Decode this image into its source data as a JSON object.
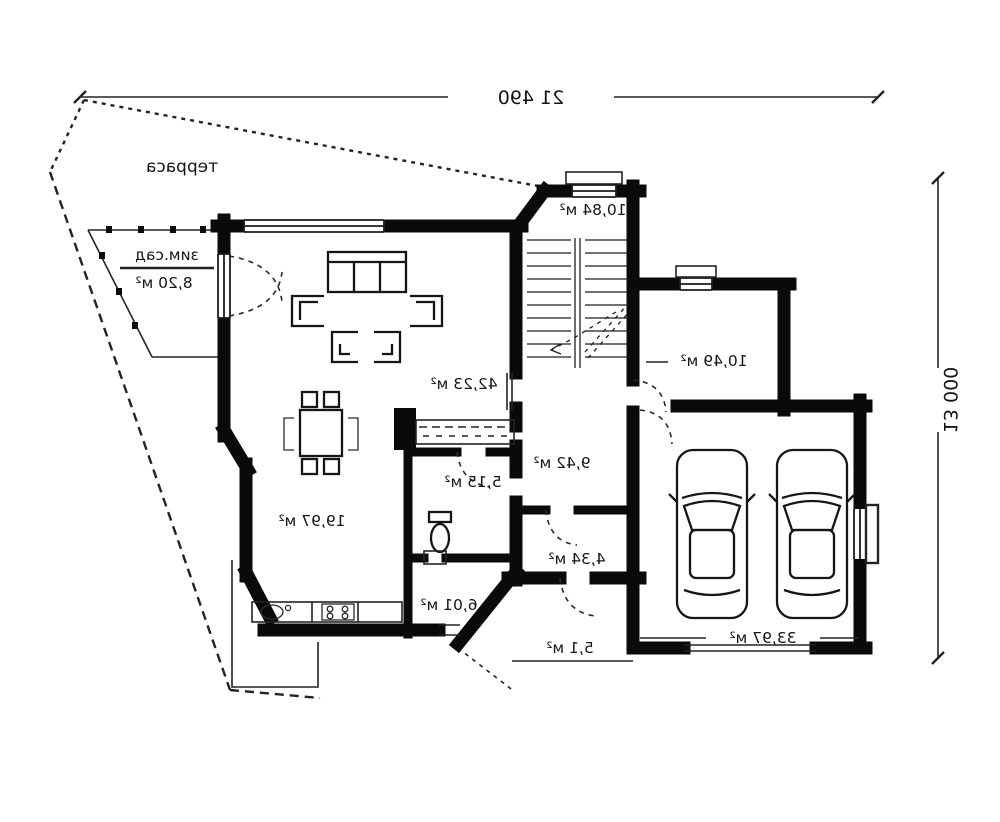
{
  "plan": {
    "dimensions": {
      "width": "21 490",
      "height": "13 000"
    },
    "outdoor": {
      "terrace": "терраса",
      "winter_garden_name": "зим.сад",
      "winter_garden_area": "8,20 м²",
      "porch_area": "5,1 м²"
    },
    "rooms": {
      "entry": "10,84 м²",
      "living": "42,23 м²",
      "kitchen": "19,97 м²",
      "wc": "5,15 м²",
      "hall": "9,42 м²",
      "study": "10,49 м²",
      "corridor": "4,34 м²",
      "bathroom": "6,01 м²",
      "garage": "33,97 м²"
    },
    "colors": {
      "wall": "#0a0a0a",
      "line": "#222222",
      "background": "#ffffff"
    }
  }
}
